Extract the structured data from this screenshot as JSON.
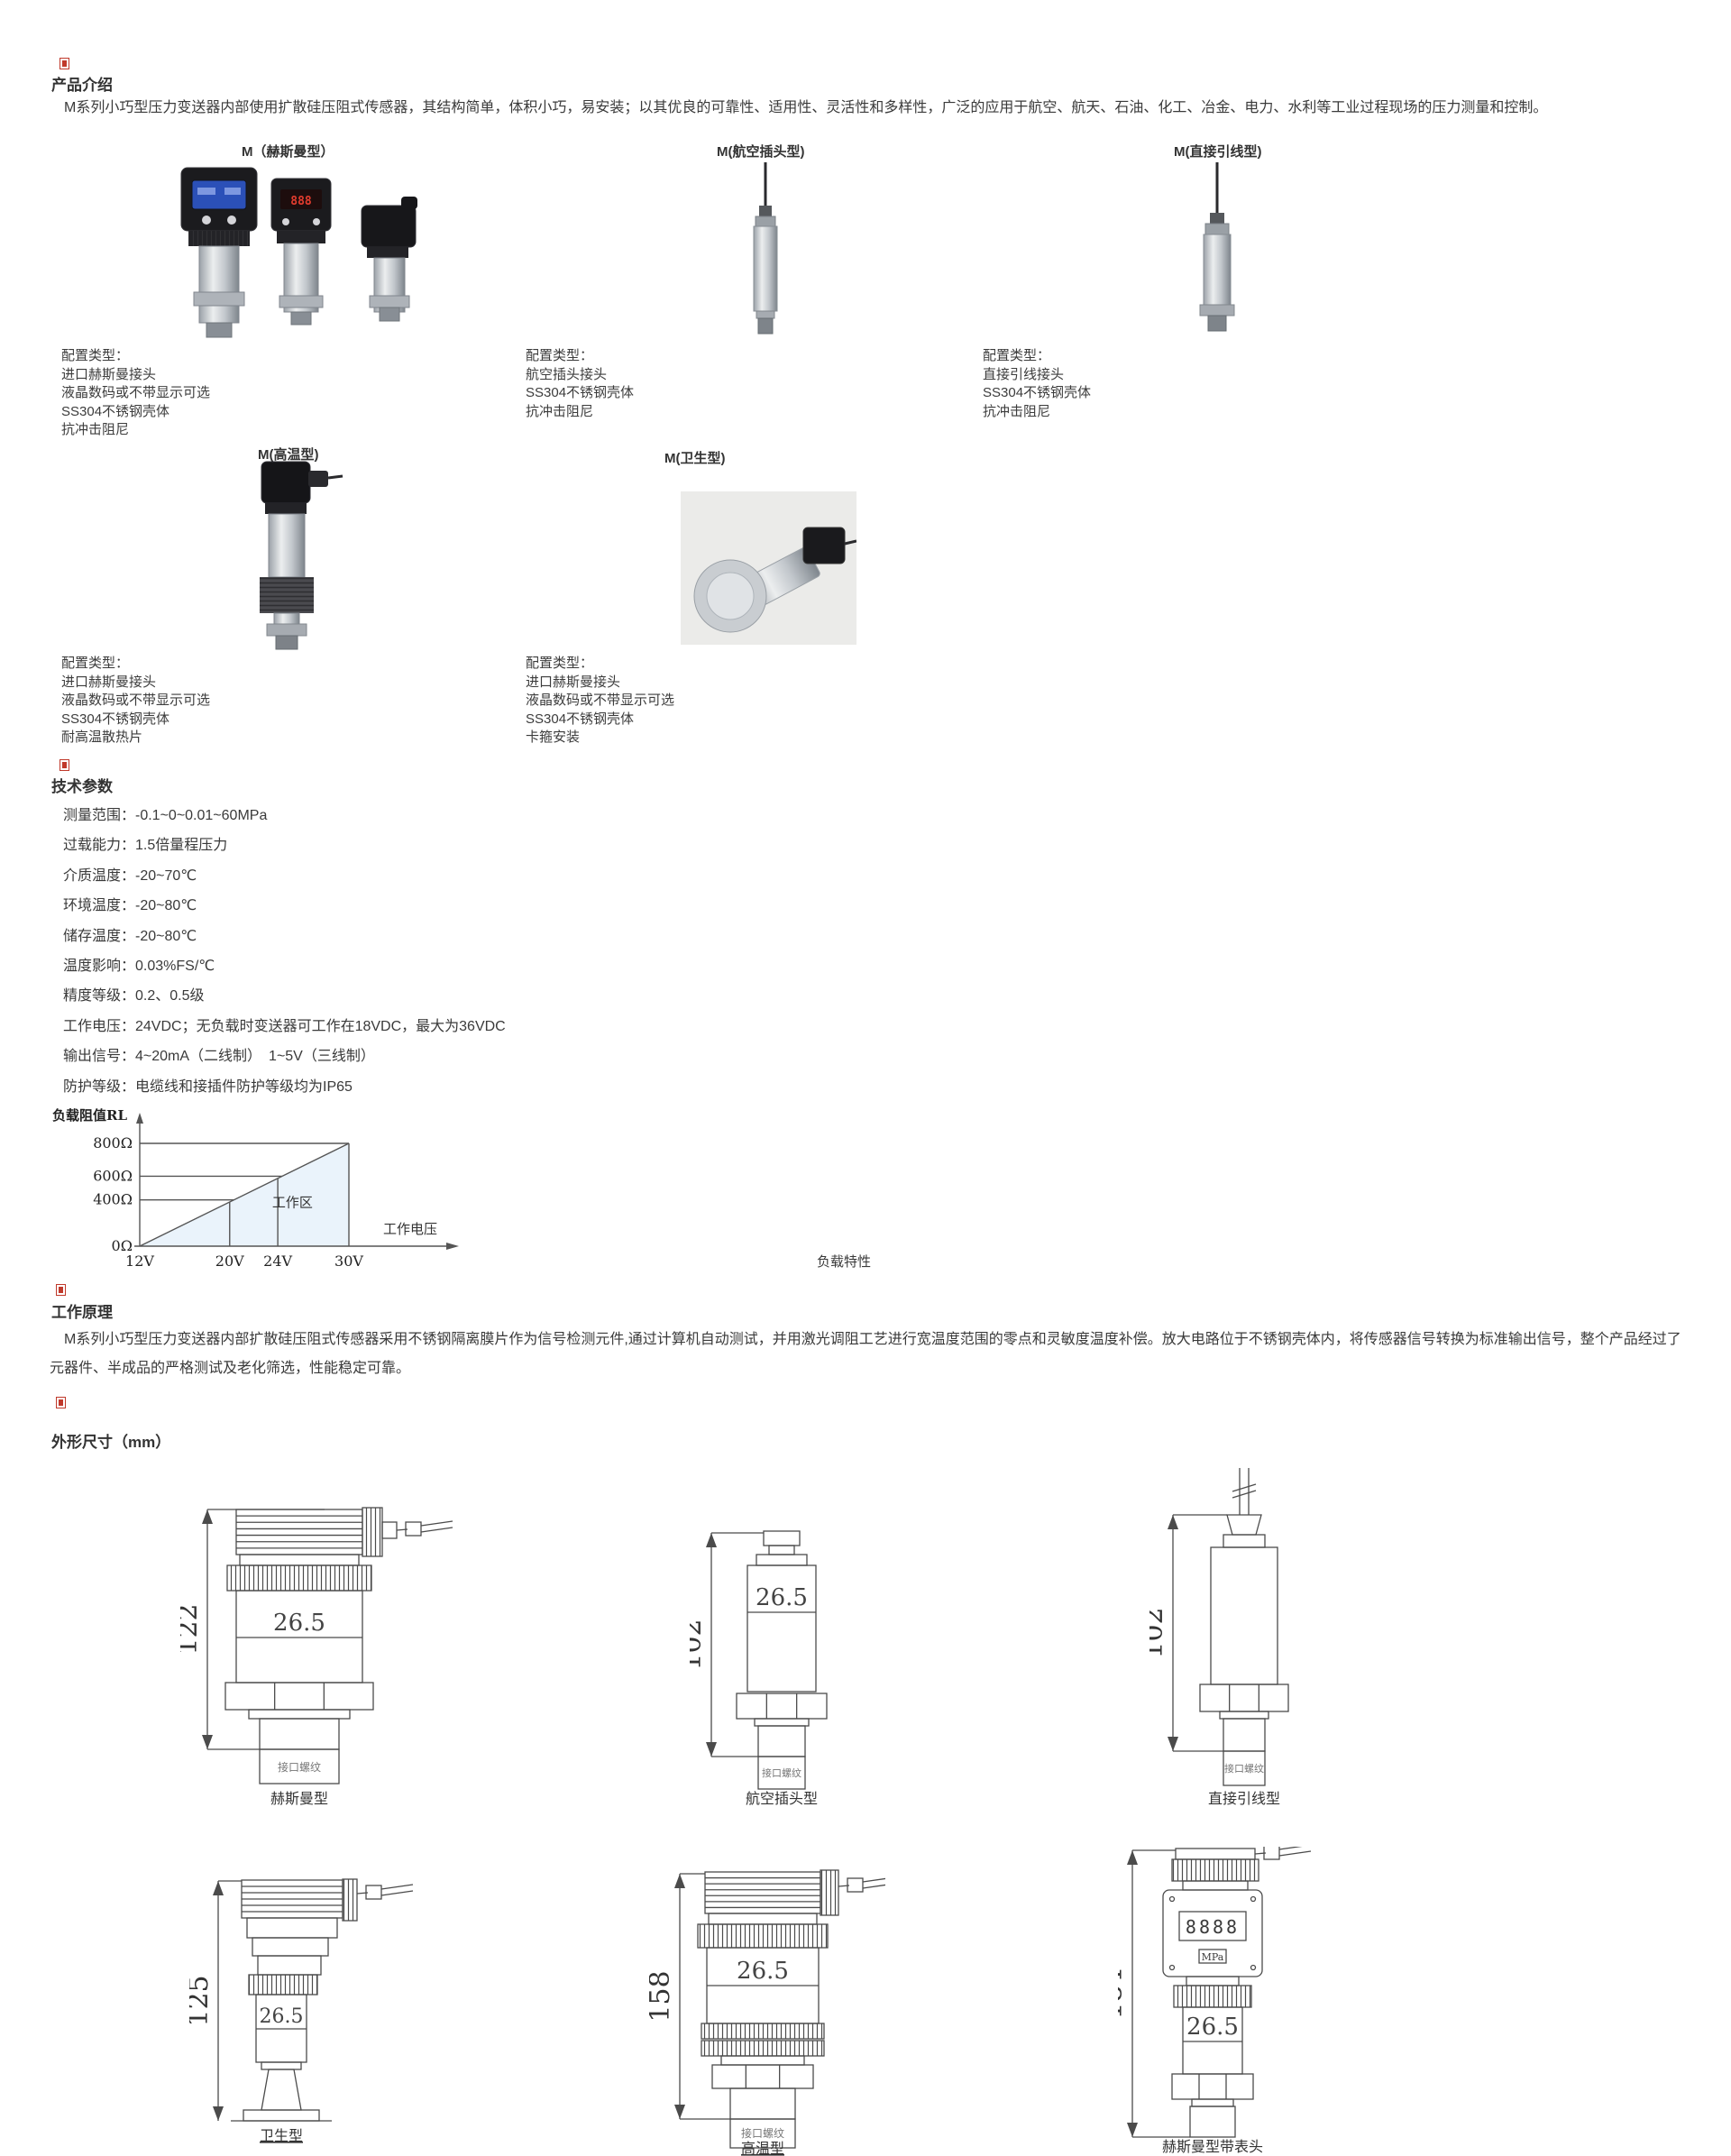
{
  "colors": {
    "section_marker": "#c0392b",
    "text": "#333333",
    "chart_fill": "#eaf3fb"
  },
  "intro": {
    "heading": "产品介绍",
    "paragraph": "M系列小巧型压力变送器内部使用扩散硅压阻式传感器，其结构简单，体积小巧，易安装；以其优良的可靠性、适用性、灵活性和多样性，广泛的应用于航空、航天、石油、化工、冶金、电力、水利等工业过程现场的压力测量和控制。"
  },
  "models_row1": [
    {
      "label": "M（赫斯曼型）",
      "config_title": "配置类型：",
      "config": [
        "进口赫斯曼接头",
        "液晶数码或不带显示可选",
        "SS304不锈钢壳体",
        "抗冲击阻尼"
      ]
    },
    {
      "label": "M(航空插头型)",
      "config_title": "配置类型：",
      "config": [
        "航空插头接头",
        "SS304不锈钢壳体",
        "抗冲击阻尼"
      ]
    },
    {
      "label": "M(直接引线型)",
      "config_title": "配置类型：",
      "config": [
        "直接引线接头",
        "SS304不锈钢壳体",
        "抗冲击阻尼"
      ]
    }
  ],
  "models_row2": [
    {
      "label": "M(高温型)",
      "config_title": "配置类型：",
      "config": [
        "进口赫斯曼接头",
        "液晶数码或不带显示可选",
        "SS304不锈钢壳体",
        "耐高温散热片"
      ]
    },
    {
      "label": "M(卫生型)",
      "config_title": "配置类型：",
      "config": [
        "进口赫斯曼接头",
        "液晶数码或不带显示可选",
        "SS304不锈钢壳体",
        "卡箍安装"
      ]
    }
  ],
  "tech": {
    "heading": "技术参数",
    "params": [
      "测量范围：-0.1~0~0.01~60MPa",
      "过载能力：1.5倍量程压力",
      "介质温度：-20~70℃",
      "环境温度：-20~80℃",
      "储存温度：-20~80℃",
      "温度影响：0.03%FS/℃",
      "精度等级：0.2、0.5级",
      "工作电压：24VDC；无负载时变送器可工作在18VDC，最大为36VDC",
      "输出信号：4~20mA（二线制）　1~5V（三线制）",
      "防护等级：电缆线和接插件防护等级均为IP65"
    ]
  },
  "chart_data": {
    "type": "area",
    "title": "负载特性",
    "ylabel": "负载阻值RL",
    "xlabel": "工作电压",
    "x_ticks": [
      "12V",
      "20V",
      "24V",
      "30V"
    ],
    "y_ticks": [
      "0Ω",
      "400Ω",
      "600Ω",
      "800Ω"
    ],
    "series": [
      {
        "name": "负载阻值RL上限",
        "x": [
          12,
          20,
          24,
          30
        ],
        "y": [
          0,
          400,
          600,
          800
        ]
      }
    ],
    "region_label": "工作区",
    "xlim": [
      12,
      30
    ],
    "ylim": [
      0,
      800
    ],
    "grid": "step-lines-to-diagonal",
    "x_tick_fracs": [
      0,
      0.43,
      0.66,
      1
    ],
    "y_tick_fracs": [
      0,
      0.45,
      0.68,
      1
    ],
    "fill_color": "#eaf3fb"
  },
  "principle": {
    "heading": "工作原理",
    "paragraph": "M系列小巧型压力变送器内部扩散硅压阻式传感器采用不锈钢隔离膜片作为信号检测元件,通过计算机自动测试，并用激光调阻工艺进行宽温度范围的零点和灵敏度温度补偿。放大电路位于不锈钢壳体内，将传感器信号转换为标准输出信号，整个产品经过了元器件、半成品的严格测试及老化筛选，性能稳定可靠。"
  },
  "dimensions": {
    "heading": "外形尺寸（mm）",
    "drawings": [
      {
        "caption": "赫斯曼型",
        "height_label": "122",
        "body_label": "26.5",
        "thread_label": "接口螺纹"
      },
      {
        "caption": "航空插头型",
        "height_label": "102",
        "body_label": "26.5",
        "thread_label": "接口螺纹"
      },
      {
        "caption": "直接引线型",
        "height_label": "102",
        "body_label": "",
        "thread_label": "接口螺纹"
      },
      {
        "caption": "卫生型",
        "height_label": "125",
        "body_label": "26.5",
        "thread_label": ""
      },
      {
        "caption": "高温型",
        "height_label": "158",
        "body_label": "26.5",
        "thread_label": "接口螺纹"
      },
      {
        "caption": "赫斯曼型带表头",
        "height_label": "184",
        "body_label": "26.5",
        "thread_label": "",
        "display_digits": "8888",
        "display_unit": "MPa"
      }
    ]
  }
}
